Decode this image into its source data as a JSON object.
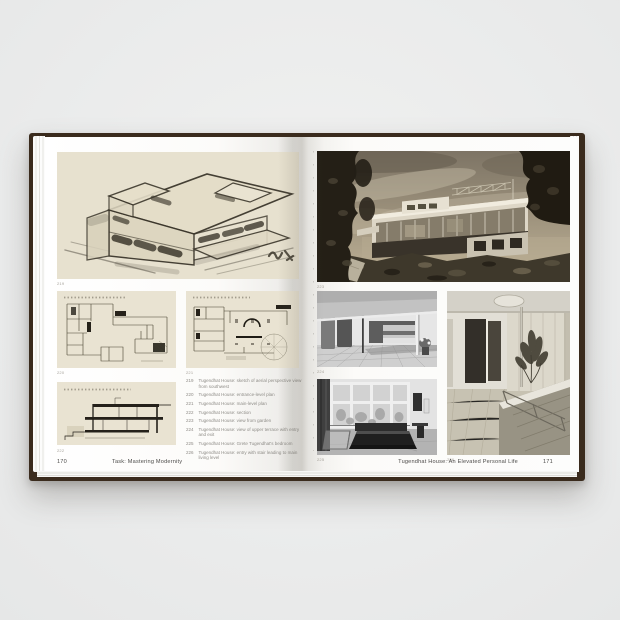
{
  "book": {
    "left_page": {
      "page_number": "170",
      "running_title": "Task: Mastering Modernity",
      "figure_numbers": {
        "sketch": "219",
        "upper_plan": "220",
        "main_plan": "221",
        "section": "222"
      },
      "captions": [
        {
          "num": "219",
          "text": "Tugendhat House: sketch of aerial perspective view from southwest"
        },
        {
          "num": "220",
          "text": "Tugendhat House: entrance-level plan"
        },
        {
          "num": "221",
          "text": "Tugendhat House: main-level plan"
        },
        {
          "num": "222",
          "text": "Tugendhat House: section"
        },
        {
          "num": "223",
          "text": "Tugendhat House: view from garden"
        },
        {
          "num": "224",
          "text": "Tugendhat House: view of upper terrace with entry and exit"
        },
        {
          "num": "225",
          "text": "Tugendhat House: Grete Tugendhat's bedroom"
        },
        {
          "num": "226",
          "text": "Tugendhat House: entry with stair leading to main living level"
        }
      ]
    },
    "right_page": {
      "page_number": "171",
      "running_title": "Tugendhat House: An Elevated Personal Life",
      "figure_numbers": {
        "garden_view": "223",
        "upper_terrace": "224",
        "bedroom": "225",
        "entrance_hall": "226"
      }
    },
    "palette": {
      "cover": "#3a2b1d",
      "backdrop": "#ebecec",
      "page": "#fcfbf9",
      "drawing_paper": "#e9e3d2"
    }
  }
}
